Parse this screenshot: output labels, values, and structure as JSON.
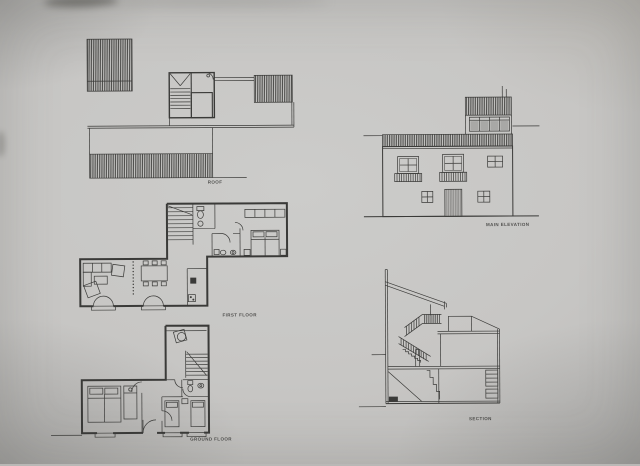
{
  "sheet": {
    "description_labels": {
      "roof_plan": "ROOF",
      "first_floor_plan": "FIRST FLOOR",
      "ground_floor_plan": "GROUND FLOOR",
      "main_elevation": "MAIN ELEVATION",
      "section": "SECTION"
    }
  },
  "colors": {
    "paper": "#c7c6c4",
    "ink": "#3a3a38",
    "hatch": "#2e2e2c"
  }
}
